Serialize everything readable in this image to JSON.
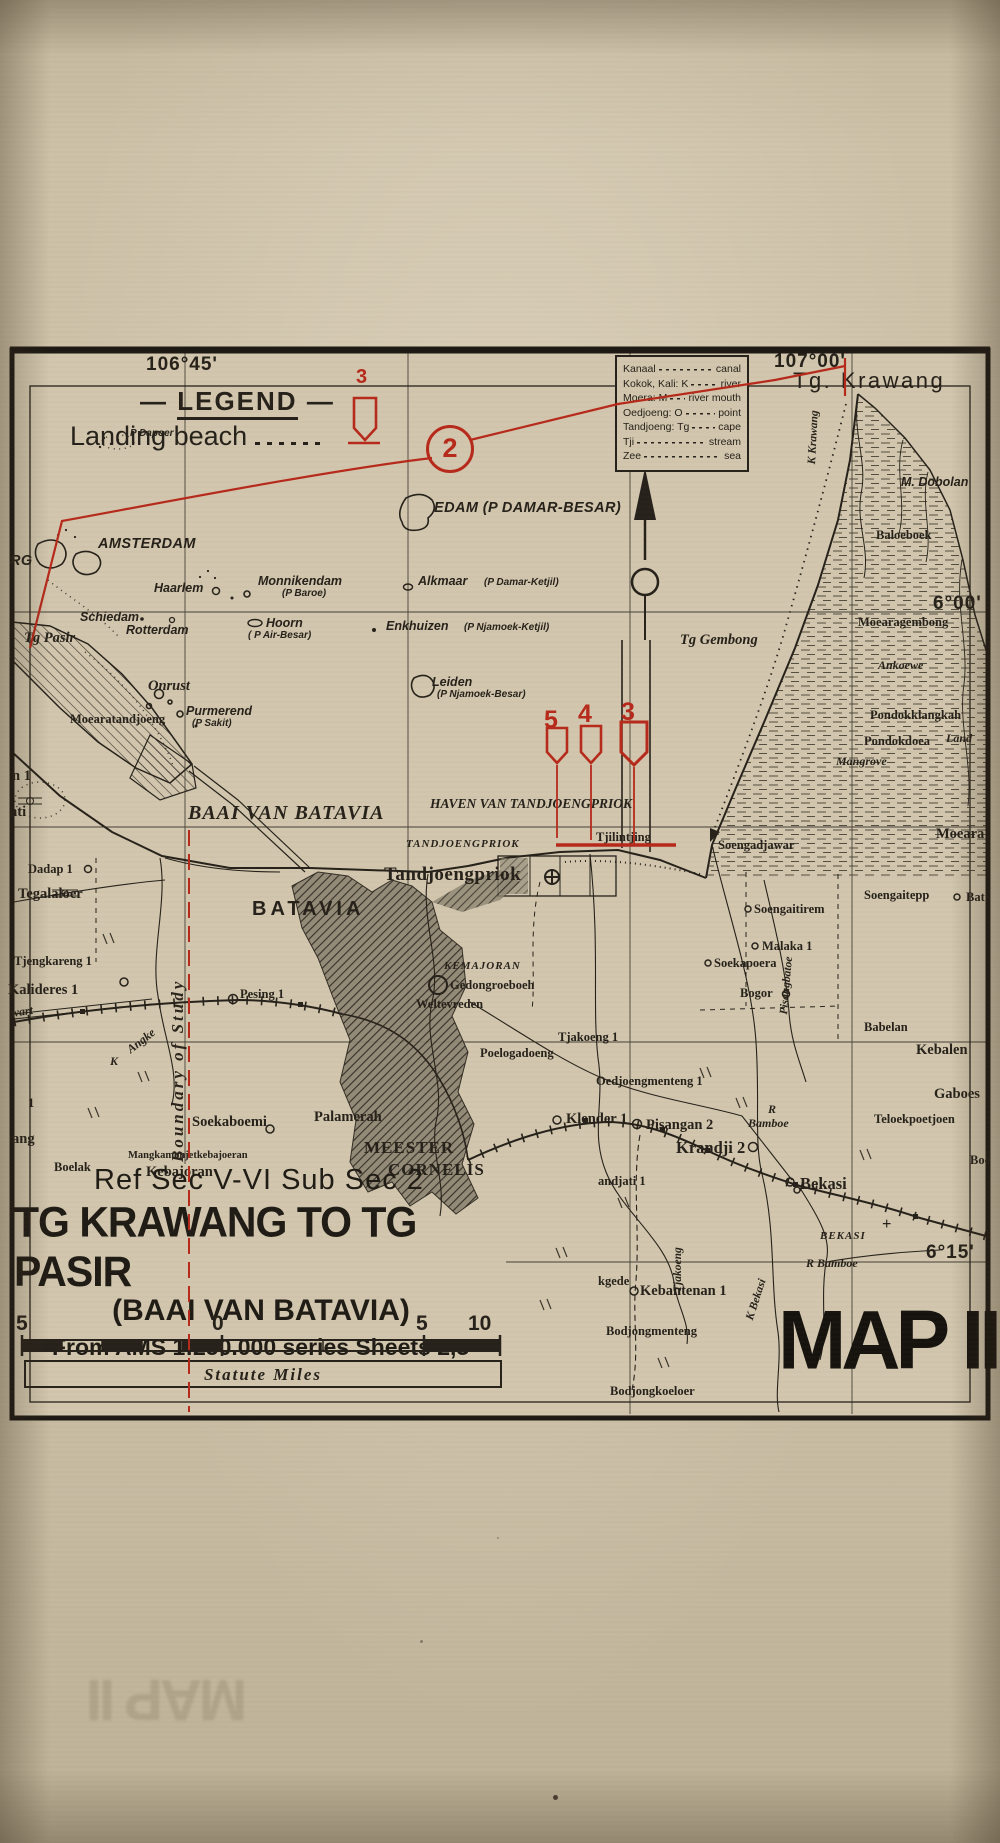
{
  "colors": {
    "paper": "#c9bda4",
    "map_paper": "#d2c7ae",
    "ink": "#26211a",
    "red": "#b7291b",
    "city_hatch": "#8e8673"
  },
  "legend": {
    "dash": "—",
    "title": "LEGEND",
    "items": [
      {
        "label": "Landing beach",
        "symbol": "landing-craft-icon",
        "symbol_number": "3"
      }
    ]
  },
  "glossary": [
    {
      "term": "Kanaal",
      "definition": "canal"
    },
    {
      "term": "Kokok, Kali: K",
      "definition": "river"
    },
    {
      "term": "Moera: M",
      "definition": "river mouth"
    },
    {
      "term": "Oedjoeng: O",
      "definition": "point"
    },
    {
      "term": "Tandjoeng: Tg",
      "definition": "cape"
    },
    {
      "term": "Tji",
      "definition": "stream"
    },
    {
      "term": "Zee",
      "definition": "sea"
    }
  ],
  "title_block": {
    "ref": "Ref Sec V-VI  Sub Sec 2",
    "title": "TG KRAWANG TO TG PASIR",
    "subtitle": "(BAAI VAN BATAVIA)",
    "source": "From AMS 1:250.000 series Sheets 2,3",
    "scale_numbers": [
      "5",
      "0",
      "5",
      "10"
    ],
    "scale_units": "Statute Miles"
  },
  "map_number": "MAP II",
  "ghost_text": "MAP II",
  "map_labels": [
    {
      "t": "106°45'",
      "x": 146,
      "y": 354,
      "c": "coord"
    },
    {
      "t": "107°00'",
      "x": 774,
      "y": 351,
      "c": "coord"
    },
    {
      "t": "6°00'",
      "x": 933,
      "y": 593,
      "c": "coord"
    },
    {
      "t": "6°15'",
      "x": 926,
      "y": 1242,
      "c": "coord"
    },
    {
      "t": "Tg. Krawang",
      "x": 793,
      "y": 368,
      "c": "cape"
    },
    {
      "t": "M. Dobolan",
      "x": 901,
      "y": 475,
      "c": "isl"
    },
    {
      "t": "RG",
      "x": 10,
      "y": 553,
      "c": "islB"
    },
    {
      "t": "AMSTERDAM",
      "x": 98,
      "y": 536,
      "c": "islB"
    },
    {
      "t": "EDAM  (P DAMAR-BESAR)",
      "x": 434,
      "y": 500,
      "c": "islB"
    },
    {
      "t": "P Dapoer",
      "x": 130,
      "y": 428,
      "c": "islS"
    },
    {
      "t": "Monnikendam",
      "x": 258,
      "y": 574,
      "c": "isl"
    },
    {
      "t": "(P Baroe)",
      "x": 282,
      "y": 588,
      "c": "islS"
    },
    {
      "t": "Haarlem",
      "x": 154,
      "y": 581,
      "c": "isl"
    },
    {
      "t": "Schiedam",
      "x": 80,
      "y": 610,
      "c": "isl"
    },
    {
      "t": "Rotterdam",
      "x": 126,
      "y": 623,
      "c": "isl"
    },
    {
      "t": "Hoorn",
      "x": 266,
      "y": 616,
      "c": "isl"
    },
    {
      "t": "( P Air-Besar)",
      "x": 248,
      "y": 630,
      "c": "islS"
    },
    {
      "t": "Alkmaar",
      "x": 418,
      "y": 574,
      "c": "isl"
    },
    {
      "t": "(P Damar-Ketjil)",
      "x": 484,
      "y": 577,
      "c": "islS"
    },
    {
      "t": "Enkhuizen",
      "x": 386,
      "y": 619,
      "c": "isl"
    },
    {
      "t": "(P Njamoek-Ketjil)",
      "x": 464,
      "y": 622,
      "c": "islS"
    },
    {
      "t": "Leiden",
      "x": 432,
      "y": 675,
      "c": "isl"
    },
    {
      "t": "(P Njamoek-Besar)",
      "x": 437,
      "y": 689,
      "c": "islS"
    },
    {
      "t": "Purmerend",
      "x": 186,
      "y": 704,
      "c": "isl"
    },
    {
      "t": "(P Sakit)",
      "x": 192,
      "y": 718,
      "c": "islS"
    },
    {
      "t": "Onrust",
      "x": 148,
      "y": 678,
      "c": "serI14"
    },
    {
      "t": "Tg Pasir",
      "x": 24,
      "y": 630,
      "c": "serI14"
    },
    {
      "t": "Tg Gembong",
      "x": 680,
      "y": 632,
      "c": "serI14"
    },
    {
      "t": "BAAI VAN BATAVIA",
      "x": 188,
      "y": 802,
      "c": "seaBig"
    },
    {
      "t": "HAVEN VAN TANDJOENGPRIOK",
      "x": 430,
      "y": 796,
      "c": "seaMed"
    },
    {
      "t": "TANDJOENGPRIOK",
      "x": 406,
      "y": 838,
      "c": "capsI"
    },
    {
      "t": "Tandjoengpriok",
      "x": 384,
      "y": 864,
      "c": "serB20"
    },
    {
      "t": "Tjilintjing",
      "x": 596,
      "y": 830,
      "c": "serB"
    },
    {
      "t": "BATAVIA",
      "x": 252,
      "y": 898,
      "c": "city"
    },
    {
      "t": "Moearatandjoeng",
      "x": 70,
      "y": 712,
      "c": "serB"
    },
    {
      "t": "n 1",
      "x": 12,
      "y": 768,
      "c": "serB15"
    },
    {
      "t": "ati",
      "x": 10,
      "y": 804,
      "c": "serB15"
    },
    {
      "t": "Dadap 1",
      "x": 28,
      "y": 862,
      "c": "serB"
    },
    {
      "t": "Tegalaloer",
      "x": 18,
      "y": 886,
      "c": "serB15"
    },
    {
      "t": "Tjengkareng 1",
      "x": 14,
      "y": 954,
      "c": "serB"
    },
    {
      "t": "Kalideres 1",
      "x": 8,
      "y": 982,
      "c": "serB15"
    },
    {
      "t": "wart",
      "x": 10,
      "y": 1006,
      "c": "serI",
      "r": -8
    },
    {
      "t": "Angke",
      "x": 124,
      "y": 1045,
      "c": "serI",
      "r": -38
    },
    {
      "t": "K",
      "x": 110,
      "y": 1054,
      "c": "serI"
    },
    {
      "t": "1",
      "x": 28,
      "y": 1096,
      "c": "serB"
    },
    {
      "t": "ang",
      "x": 12,
      "y": 1131,
      "c": "serB15"
    },
    {
      "t": "Boelak",
      "x": 54,
      "y": 1160,
      "c": "serB"
    },
    {
      "t": "Mangkamonjetkebajoeran",
      "x": 128,
      "y": 1150,
      "c": "ser11"
    },
    {
      "t": "Kebajoran",
      "x": 146,
      "y": 1164,
      "c": "serB15"
    },
    {
      "t": "Pesing 1",
      "x": 240,
      "y": 987,
      "c": "serB"
    },
    {
      "t": "Soekaboemi",
      "x": 192,
      "y": 1114,
      "c": "serB15"
    },
    {
      "t": "Palamerah",
      "x": 314,
      "y": 1109,
      "c": "serB15"
    },
    {
      "t": "MEESTER",
      "x": 364,
      "y": 1138,
      "c": "meester"
    },
    {
      "t": "CORNELIS",
      "x": 388,
      "y": 1160,
      "c": "meester"
    },
    {
      "t": "KEMAJORAN",
      "x": 444,
      "y": 960,
      "c": "capsI"
    },
    {
      "t": "Gedongroeboeh",
      "x": 450,
      "y": 978,
      "c": "serB"
    },
    {
      "t": "Weltevreden",
      "x": 416,
      "y": 997,
      "c": "serB"
    },
    {
      "t": "Poelogadoeng",
      "x": 480,
      "y": 1046,
      "c": "serB"
    },
    {
      "t": "Oedjoengmenteng 1",
      "x": 596,
      "y": 1074,
      "c": "serB"
    },
    {
      "t": "Tjakoeng 1",
      "x": 558,
      "y": 1030,
      "c": "serB"
    },
    {
      "t": "Klender 1",
      "x": 566,
      "y": 1111,
      "c": "serB15"
    },
    {
      "t": "Pisangan 2",
      "x": 646,
      "y": 1117,
      "c": "serB15"
    },
    {
      "t": "Krandji 2",
      "x": 676,
      "y": 1138,
      "c": "serB17"
    },
    {
      "t": "Bekasi",
      "x": 800,
      "y": 1174,
      "c": "serB17"
    },
    {
      "t": "andjati 1",
      "x": 598,
      "y": 1174,
      "c": "serB"
    },
    {
      "t": "R",
      "x": 768,
      "y": 1102,
      "c": "serI"
    },
    {
      "t": "Bamboe",
      "x": 748,
      "y": 1116,
      "c": "serI"
    },
    {
      "t": "BEKASI",
      "x": 820,
      "y": 1230,
      "c": "capsI"
    },
    {
      "t": "R Bamboe",
      "x": 806,
      "y": 1256,
      "c": "serI"
    },
    {
      "t": "kgede",
      "x": 598,
      "y": 1274,
      "c": "serB"
    },
    {
      "t": "Kebantenan 1",
      "x": 640,
      "y": 1283,
      "c": "serB15"
    },
    {
      "t": "Bodjongmenteng",
      "x": 606,
      "y": 1324,
      "c": "serB"
    },
    {
      "t": "Bodjongkoeloer",
      "x": 610,
      "y": 1384,
      "c": "serB"
    },
    {
      "t": "Tjakoeng",
      "x": 672,
      "y": 1292,
      "c": "vriver",
      "r": -90
    },
    {
      "t": "K Bekasi",
      "x": 744,
      "y": 1318,
      "c": "vriver",
      "r": -72
    },
    {
      "t": "Pisangbatoe",
      "x": 778,
      "y": 1014,
      "c": "vriver",
      "r": -85
    },
    {
      "t": "K Krawang",
      "x": 806,
      "y": 464,
      "c": "vriver",
      "r": -87
    },
    {
      "t": "Baloeboek",
      "x": 876,
      "y": 528,
      "c": "serB"
    },
    {
      "t": "Moearagembong",
      "x": 858,
      "y": 615,
      "c": "serB"
    },
    {
      "t": "Ankoewe",
      "x": 878,
      "y": 658,
      "c": "serI"
    },
    {
      "t": "Pondokklangkah",
      "x": 870,
      "y": 708,
      "c": "serB"
    },
    {
      "t": "Pondokdoea",
      "x": 864,
      "y": 734,
      "c": "serB"
    },
    {
      "t": "Mangrove",
      "x": 836,
      "y": 754,
      "c": "serI"
    },
    {
      "t": "Land",
      "x": 946,
      "y": 731,
      "c": "serI"
    },
    {
      "t": "Moeara",
      "x": 936,
      "y": 826,
      "c": "serB15"
    },
    {
      "t": "Bat",
      "x": 966,
      "y": 890,
      "c": "serB"
    },
    {
      "t": "Soengadjawar",
      "x": 718,
      "y": 838,
      "c": "serB"
    },
    {
      "t": "Soengaitepp",
      "x": 864,
      "y": 888,
      "c": "serB"
    },
    {
      "t": "Soengaitirem",
      "x": 754,
      "y": 902,
      "c": "serB"
    },
    {
      "t": "Malaka 1",
      "x": 762,
      "y": 939,
      "c": "serB"
    },
    {
      "t": "Soekapoera",
      "x": 714,
      "y": 956,
      "c": "serB"
    },
    {
      "t": "Bogor",
      "x": 740,
      "y": 986,
      "c": "serB"
    },
    {
      "t": "Babelan",
      "x": 864,
      "y": 1020,
      "c": "serB"
    },
    {
      "t": "Kebalen",
      "x": 916,
      "y": 1042,
      "c": "serB15"
    },
    {
      "t": "Gaboes",
      "x": 934,
      "y": 1086,
      "c": "serB15"
    },
    {
      "t": "Teloekpoetjoen",
      "x": 874,
      "y": 1112,
      "c": "serB"
    },
    {
      "t": "Boe",
      "x": 970,
      "y": 1153,
      "c": "serB"
    },
    {
      "t": "+",
      "x": 882,
      "y": 1214,
      "c": "serB17"
    },
    {
      "t": "Boundary of Study",
      "x": 168,
      "y": 1162,
      "c": "boundary",
      "r": -90,
      "n": "boundary-of-study-label"
    },
    {
      "t": "3",
      "x": 356,
      "y": 366,
      "c": "redNumS",
      "n": "legend-beach-number"
    },
    {
      "t": "2",
      "x": 426,
      "y": 425,
      "c": "red2",
      "n": "circled-2-marker"
    },
    {
      "t": "5",
      "x": 544,
      "y": 706,
      "c": "redNum",
      "n": "beach-number-5"
    },
    {
      "t": "4",
      "x": 578,
      "y": 700,
      "c": "redNum",
      "n": "beach-number-4"
    },
    {
      "t": "3",
      "x": 621,
      "y": 698,
      "c": "redNum",
      "n": "beach-number-3"
    }
  ]
}
